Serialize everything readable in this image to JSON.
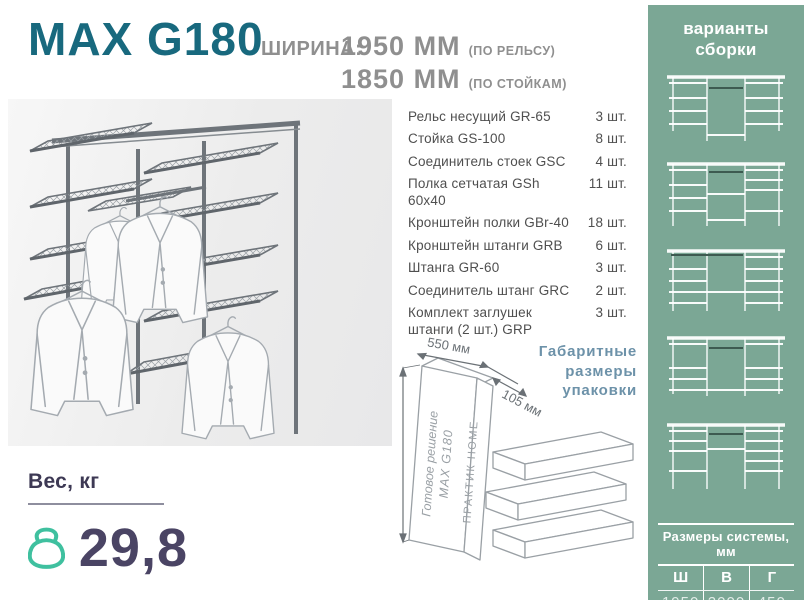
{
  "header": {
    "title": "MAX G180",
    "width_label": "ШИРИНА:",
    "width1_value": "1950 ММ",
    "width1_note": "(ПО РЕЛЬСУ)",
    "width2_value": "1850 ММ",
    "width2_note": "(ПО СТОЙКАМ)"
  },
  "parts": {
    "items": [
      {
        "name": "Рельс несущий GR-65",
        "qty": "3 шт."
      },
      {
        "name": "Стойка GS-100",
        "qty": "8 шт."
      },
      {
        "name": "Соединитель стоек GSC",
        "qty": "4 шт."
      },
      {
        "name": "Полка сетчатая GSh 60x40",
        "qty": "11 шт."
      },
      {
        "name": "Кронштейн полки GBr-40",
        "qty": "18 шт."
      },
      {
        "name": "Кронштейн штанги GRB",
        "qty": "6 шт."
      },
      {
        "name": "Штанга GR-60",
        "qty": "3 шт."
      },
      {
        "name": "Соединитель штанг GRC",
        "qty": "2 шт."
      },
      {
        "name": "Комплект заглушек штанги (2 шт.) GRP",
        "qty": "3 шт."
      }
    ]
  },
  "package": {
    "label_line1": "Габаритные",
    "label_line2": "размеры",
    "label_line3": "упаковки",
    "dim_width": "550 мм",
    "dim_depth": "105 мм",
    "dim_height": "1010 мм",
    "box_line1": "Готовое решение",
    "box_line2": "MAX G180",
    "box_side": "ПРАКТИК HOME"
  },
  "weight": {
    "label": "Вес, кг",
    "value": "29,8"
  },
  "sidebar": {
    "title_line1": "варианты",
    "title_line2": "сборки",
    "table_caption": "Размеры системы, мм",
    "col_w": "Ш",
    "col_h": "В",
    "col_d": "Г",
    "val_w": "1950",
    "val_h": "2000",
    "val_d": "450"
  },
  "colors": {
    "accent_teal": "#18697E",
    "sidebar_green": "#7BA795",
    "label_blue": "#6D92A9",
    "weight_purple": "#4A4464",
    "kettlebell_mint": "#3FC09F",
    "text_gray": "#8F8F8F"
  }
}
